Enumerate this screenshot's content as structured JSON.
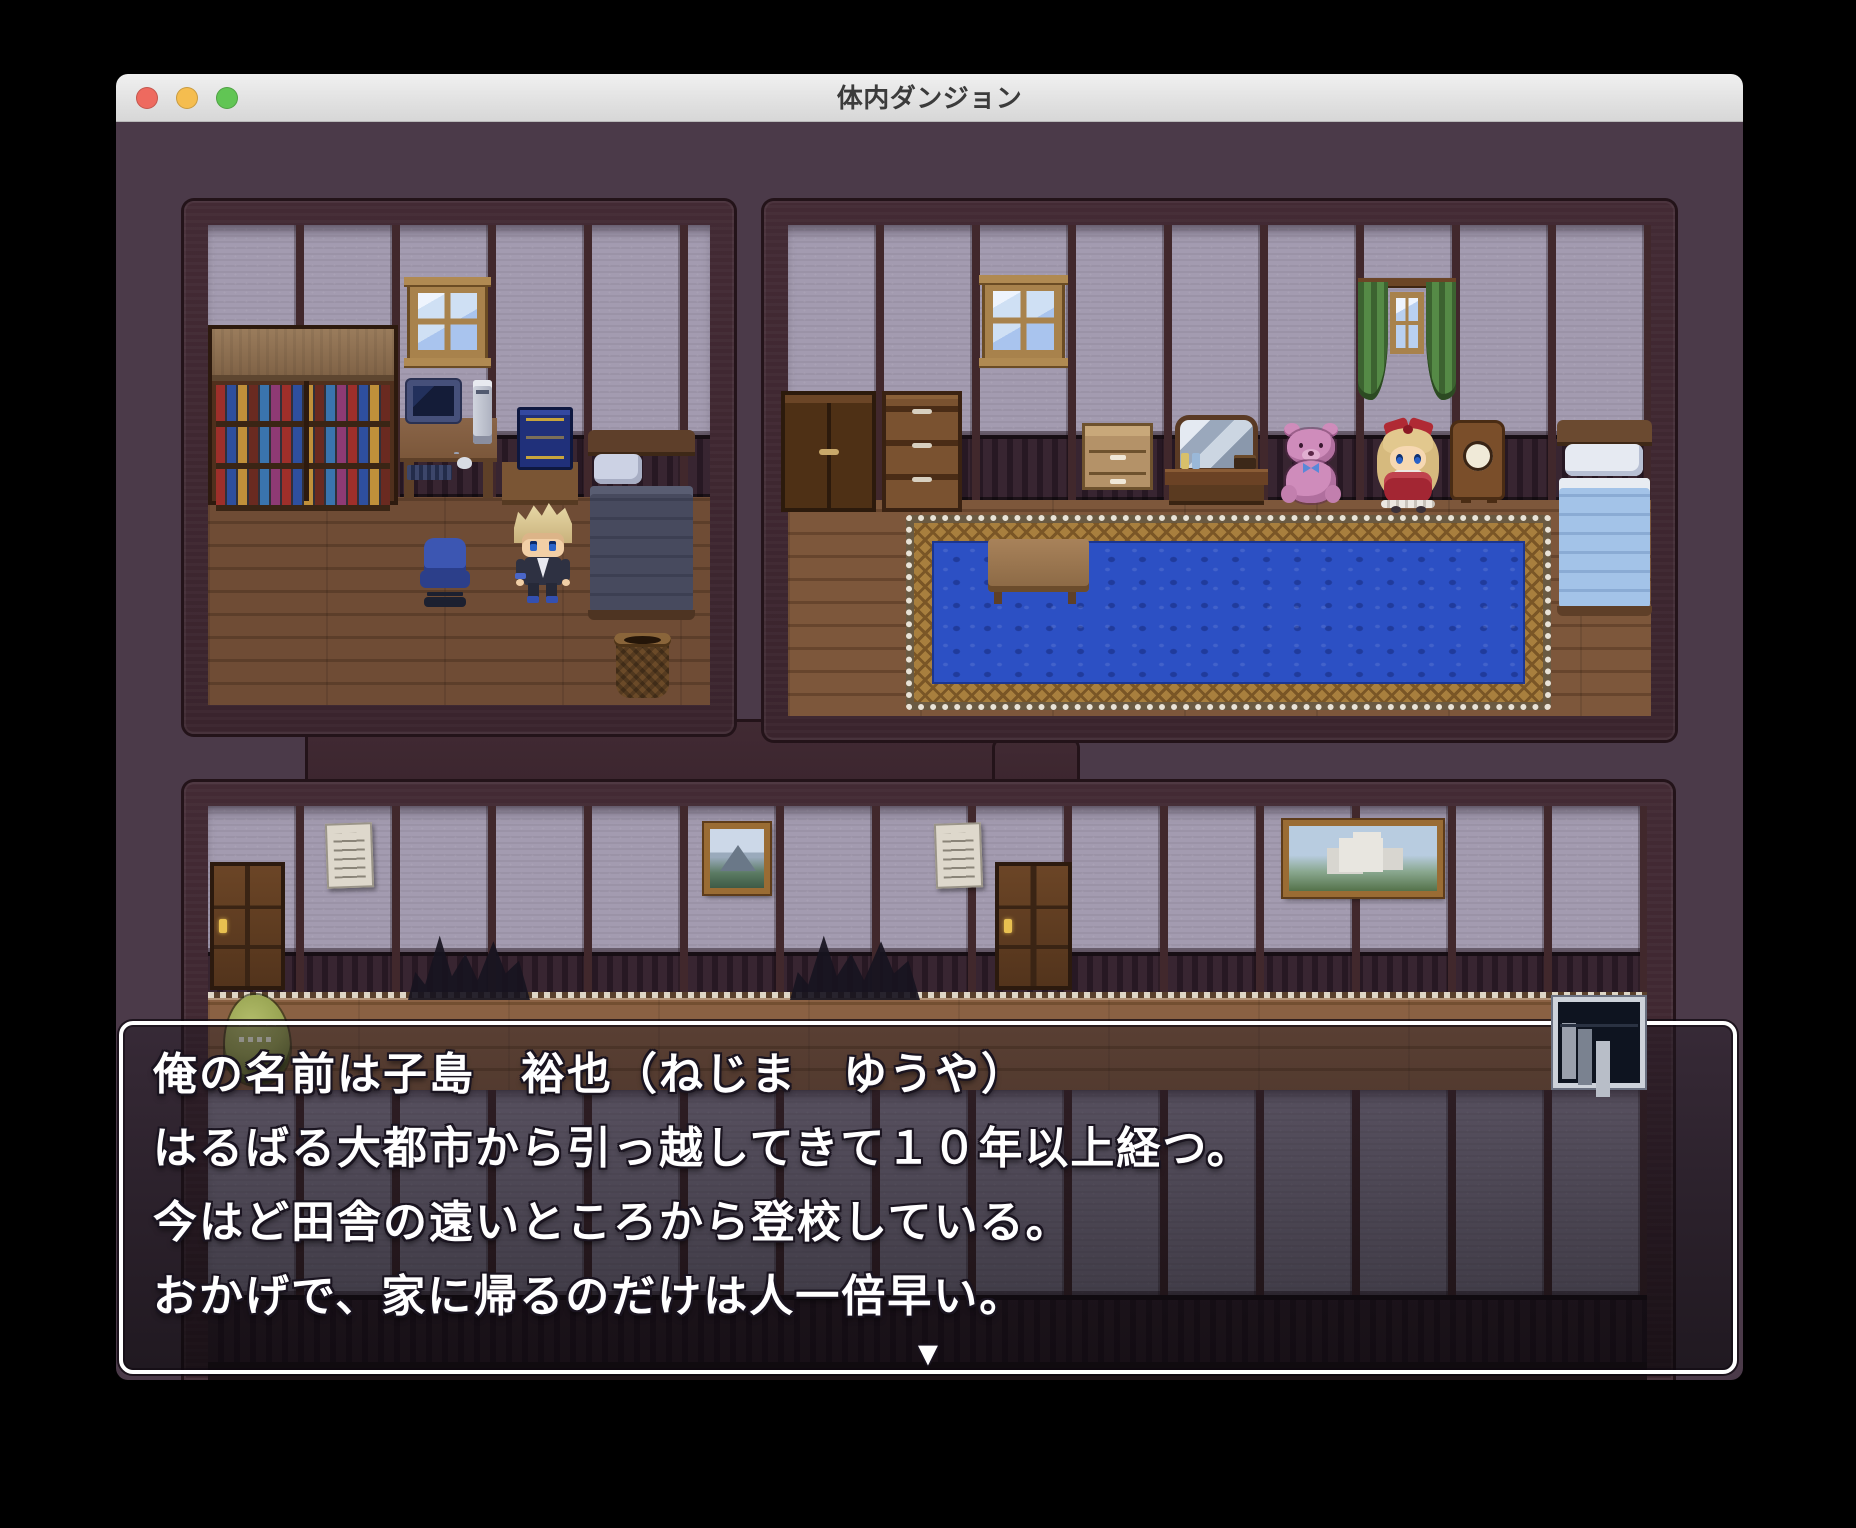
{
  "window": {
    "title": "体内ダンジョン",
    "controls": [
      "close",
      "minimize",
      "zoom"
    ]
  },
  "dialog": {
    "lines": [
      "俺の名前は子島　裕也（ねじま　ゆうや）",
      "はるばる大都市から引っ越してきて１０年以上経つ。",
      "今はど田舎の遠いところから登校している。",
      "おかげで、家に帰るのだけは人一倍早い。"
    ],
    "continue_indicator": "▼"
  },
  "scene": {
    "left_room": {
      "name": "boy's bedroom",
      "objects": [
        "double bookshelf with colored books",
        "wooden window",
        "computer desk with CRT monitor, keyboard, mouse and PC tower",
        "navy grimoire on side table",
        "bed with dark blanket and white pillow",
        "blue office chair",
        "woven basket"
      ],
      "characters": [
        "blonde protagonist in dark school jacket"
      ]
    },
    "right_room": {
      "name": "girl's bedroom",
      "objects": [
        "dark wardrobe",
        "chest of drawers",
        "wooden window",
        "window with green curtains",
        "light nightstand",
        "vanity with mirror and perfume bottles",
        "pink teddy bear with blue bow",
        "blonde doll in red dress",
        "mantel clock",
        "bed with light blue blanket",
        "large blue ornate rug",
        "wooden stool"
      ]
    },
    "hallway": {
      "name": "lower hallway",
      "objects": [
        "wooden door left",
        "wooden door right",
        "paper poster left",
        "paper poster right",
        "mountain painting",
        "castle painting",
        "dark spiky shadow left",
        "dark spiky shadow right",
        "white-framed bookshelf"
      ],
      "characters": [
        "green slime creature"
      ]
    }
  },
  "palette": {
    "game-bg": "#4b3a49",
    "frame": "#3a242d",
    "wall": "#a39bb0",
    "pillar": "#41282c",
    "wainscot": "#271823",
    "floor-l": "#6f4c35",
    "floor-r": "#7d573b",
    "hall-floor": "#8a6143",
    "rug-blue": "#2c50c4",
    "rug-gold": "#a87f3e",
    "light-red": "#ee6a5f",
    "light-yellow": "#f5bd4f",
    "light-green": "#61c554",
    "title-text": "#3b3b3b"
  }
}
